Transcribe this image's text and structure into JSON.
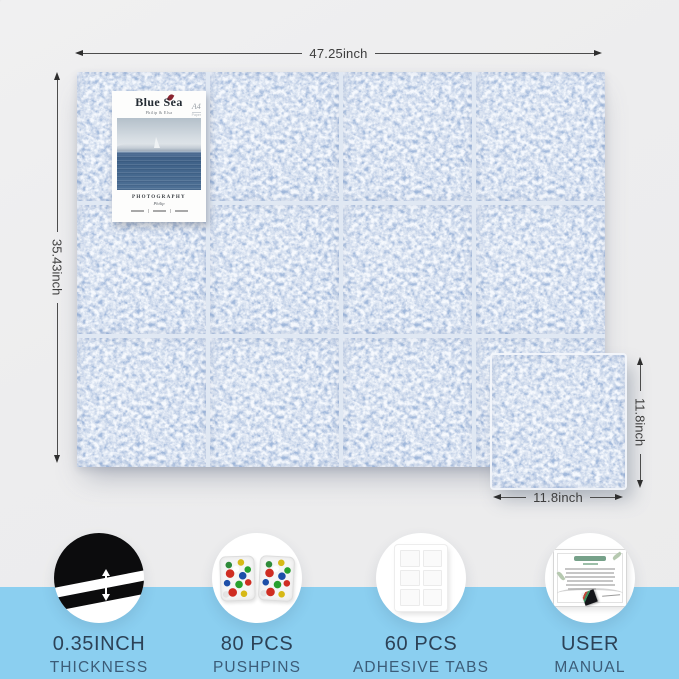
{
  "product_board": {
    "dimension_labels": {
      "board_width": "47.25inch",
      "board_height": "35.43inch",
      "tile_height": "11.8inch",
      "tile_width": "11.8inch"
    },
    "poster": {
      "title": "Blue Sea",
      "subtitle": "Philip & Elsa",
      "corner_badge_line1": "A4",
      "corner_badge_line2": "Paper",
      "caption": "PHOTOGRAPHY",
      "author": "Philip"
    },
    "grid": {
      "columns": 4,
      "rows": 3
    },
    "features": [
      {
        "icon": "felt-thickness-closeup",
        "line1": "0.35INCH",
        "line2": "THICKNESS"
      },
      {
        "icon": "pushpin-boxes",
        "line1": "80 PCS",
        "line2": "PUSHPINS"
      },
      {
        "icon": "adhesive-tabs-sheet",
        "line1": "60 PCS",
        "line2": "ADHESIVE TABS"
      },
      {
        "icon": "user-manual-page",
        "line1": "USER",
        "line2": "MANUAL"
      }
    ],
    "colors": {
      "felt_blue": "#a0b8db",
      "tile_gap": "#e0e8f3",
      "band_blue": "#8bcff0",
      "background_gray": "#ededee",
      "label_navy": "#2c4257",
      "dimension_text": "#3e3e3e"
    }
  }
}
